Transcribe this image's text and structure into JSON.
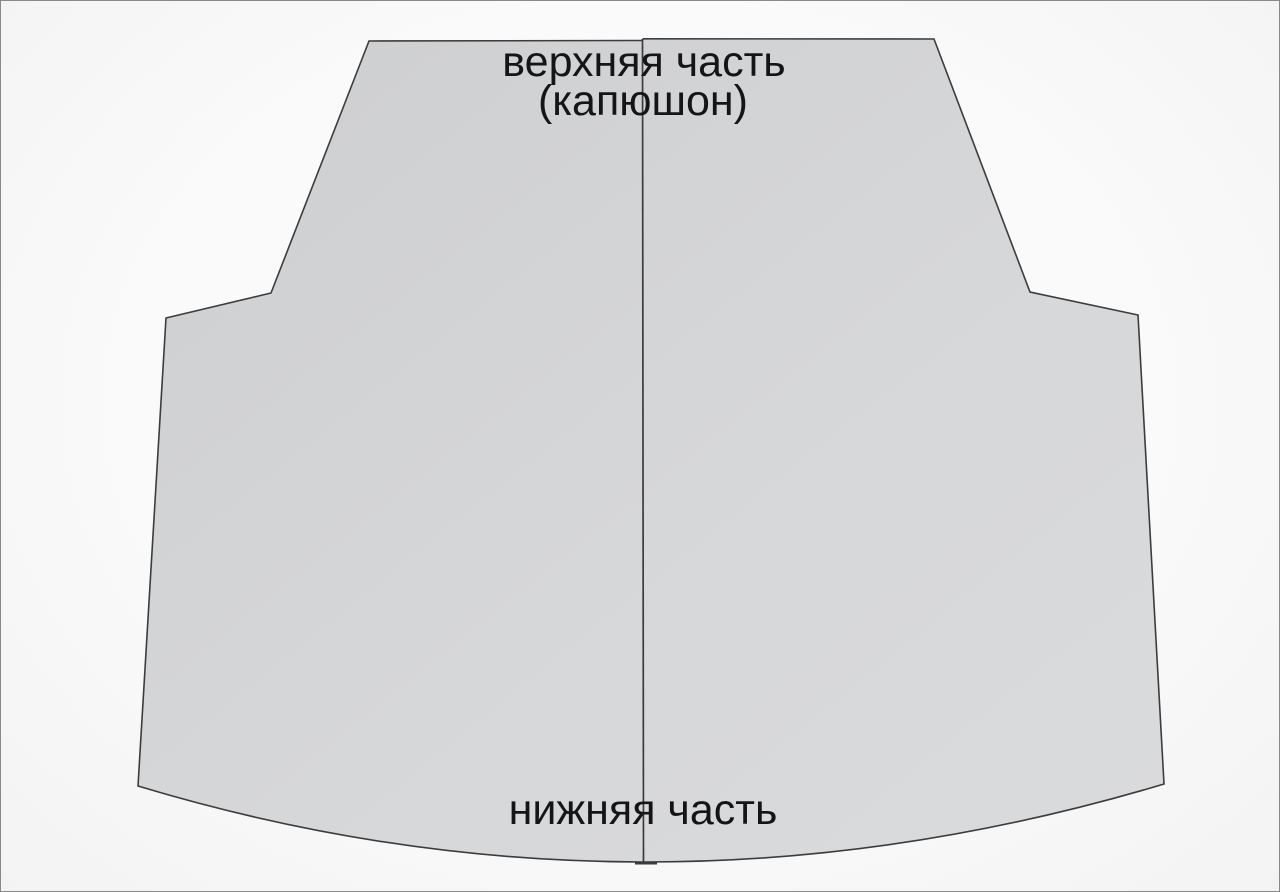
{
  "diagram": {
    "labels": {
      "top_line1": "верхняя часть",
      "top_line2": "(капюшон)",
      "bottom": "нижняя часть"
    },
    "colors": {
      "canvas_background": "#f8f8f8",
      "frame_border": "#898989",
      "piece_fill_dark": "#cdced0",
      "piece_fill_light": "#dadbdd",
      "piece_outline": "#3c3c3c",
      "seam_line": "#3c3c3c",
      "label_text": "#151515"
    }
  }
}
